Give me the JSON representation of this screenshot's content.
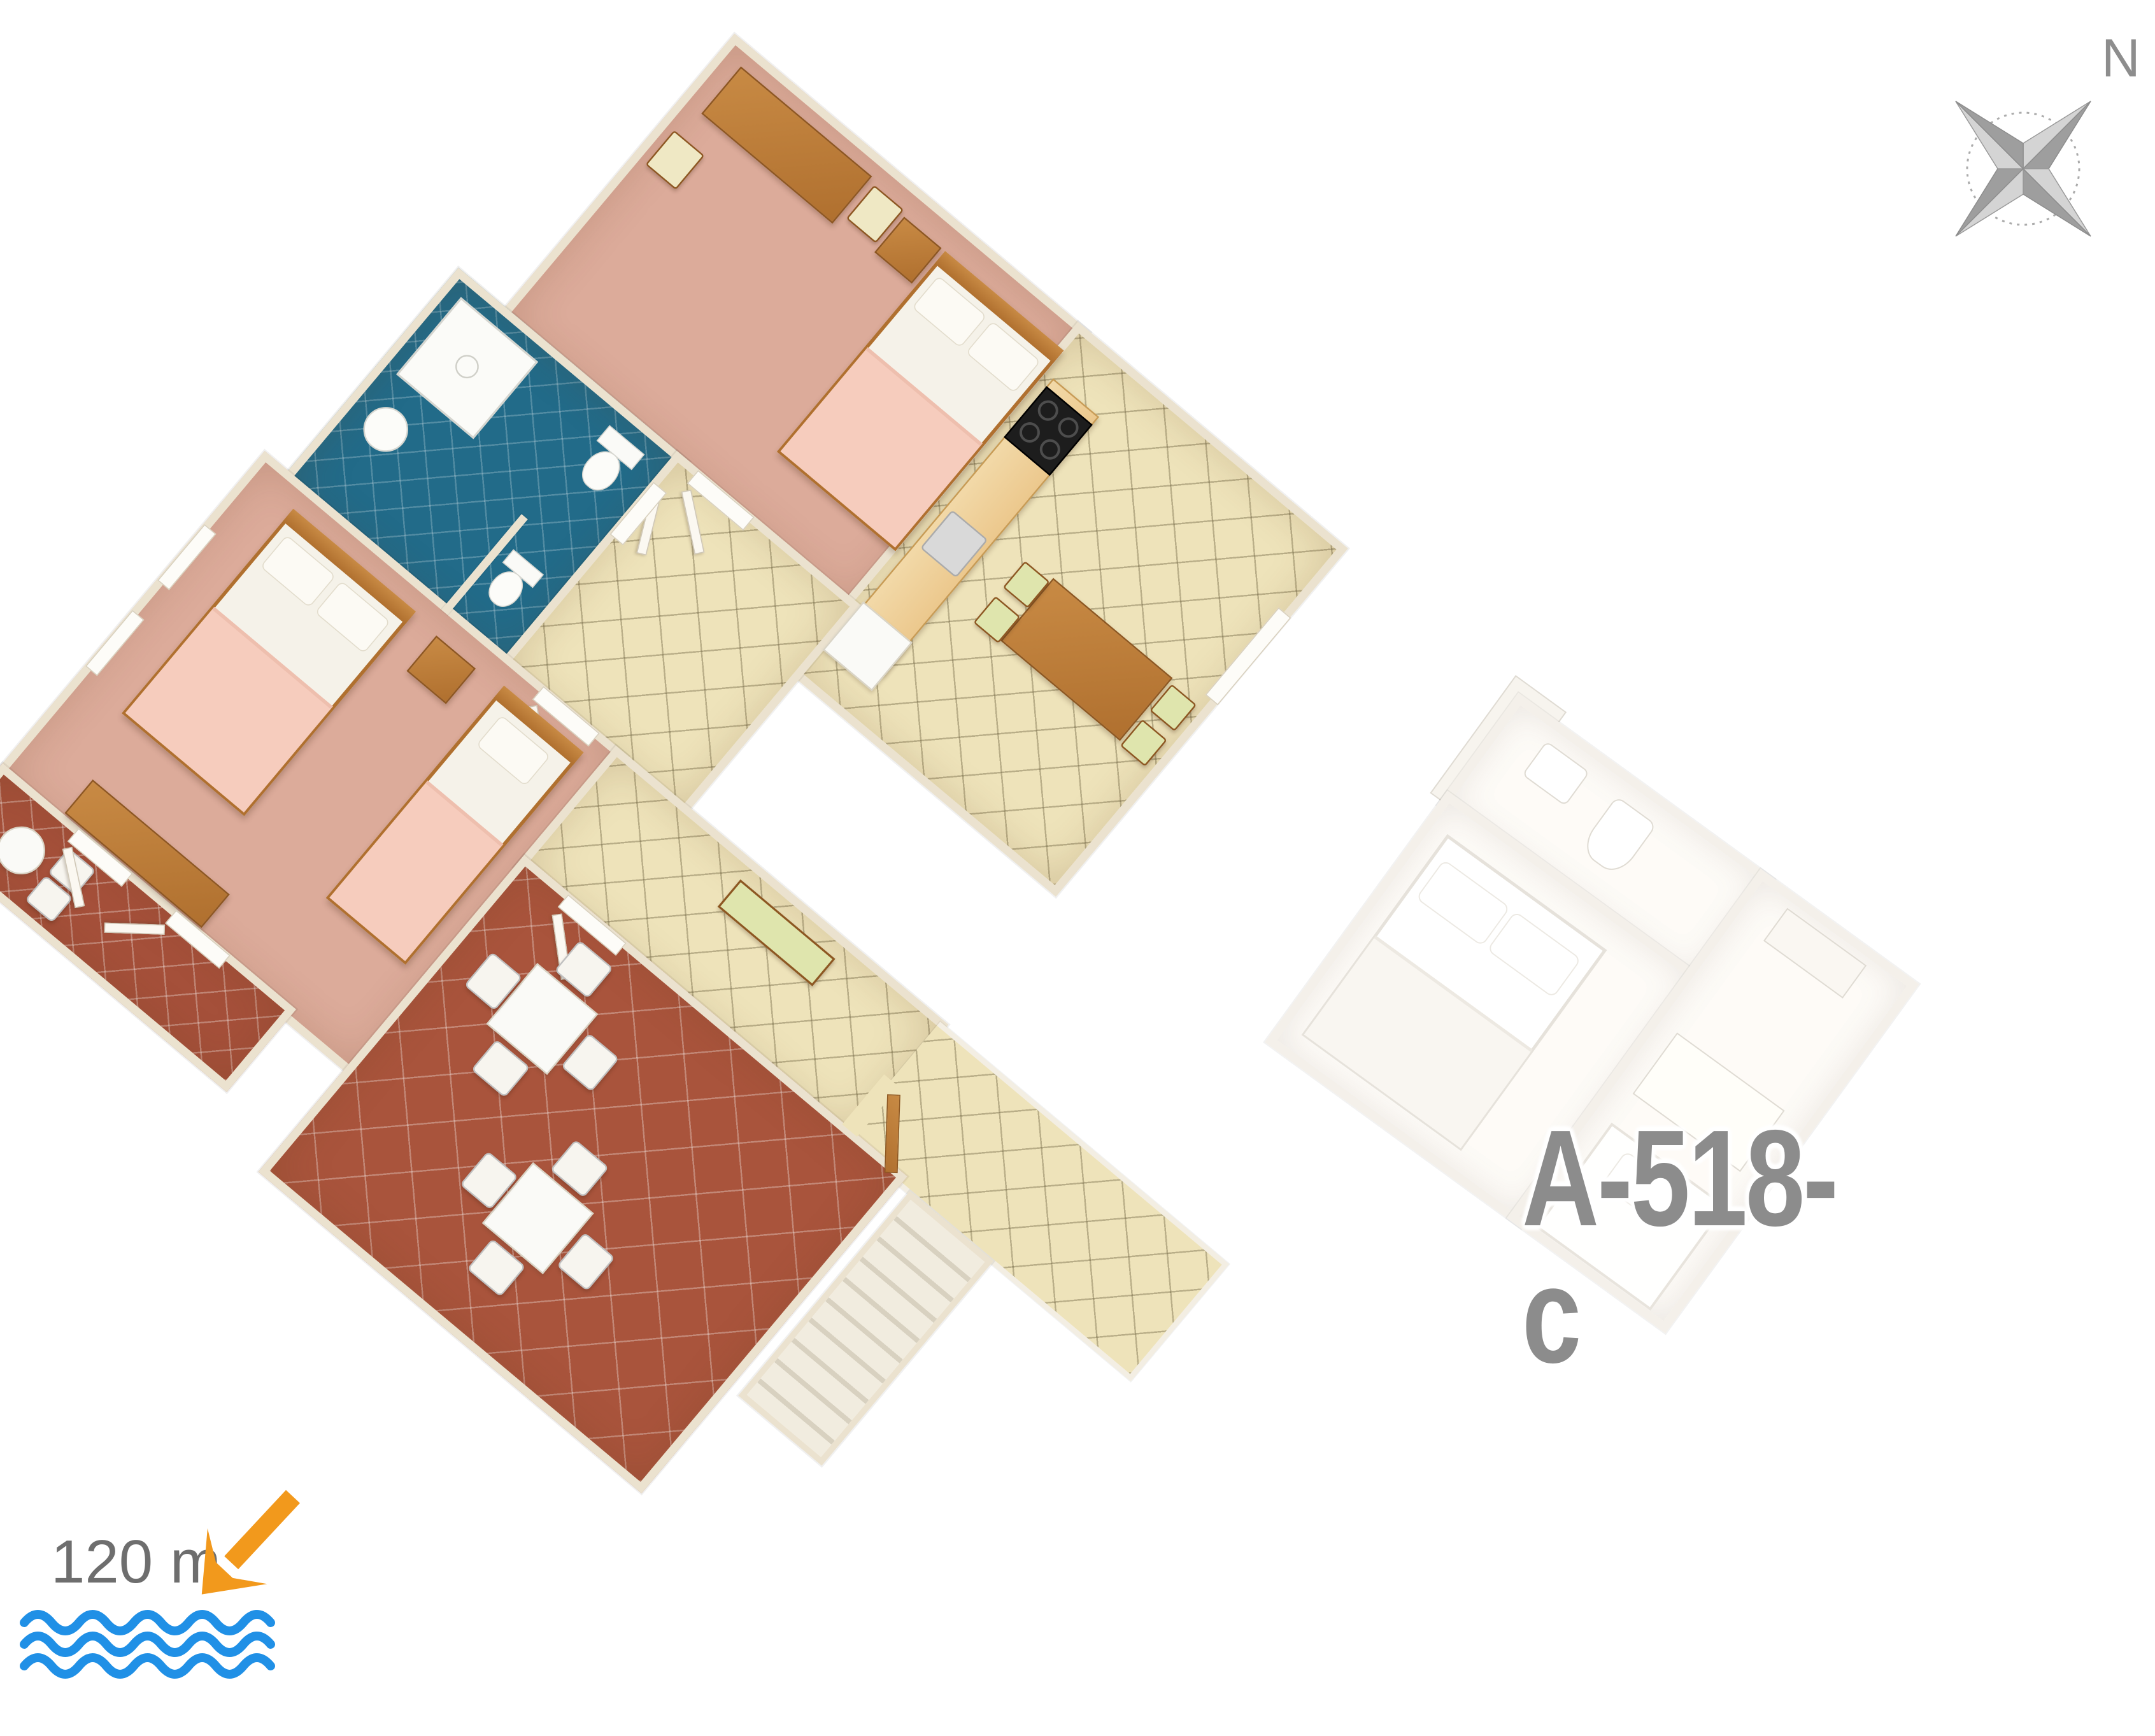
{
  "scene": {
    "background": "#ffffff"
  },
  "adjacent_unit": {
    "label": "A-518-c"
  },
  "compass": {
    "north_label": "N"
  },
  "sea_indicator": {
    "distance_text": "120 m"
  },
  "palette": {
    "wall": "#ebe2cf",
    "carpet": "#dcab9a",
    "terracotta": "#a9543c",
    "hall_tile": "#eee3ba",
    "bath_floor": "#226b89",
    "wood": "#b0702f",
    "wood_light": "#ecc88d",
    "linen": "#f5f2e9",
    "blanket": "#f6ccbd",
    "arrow_orange": "#f2991c",
    "wave_blue": "#2090e6",
    "text_gray": "#6e6e6e",
    "label_gray": "#8c8c8c"
  }
}
